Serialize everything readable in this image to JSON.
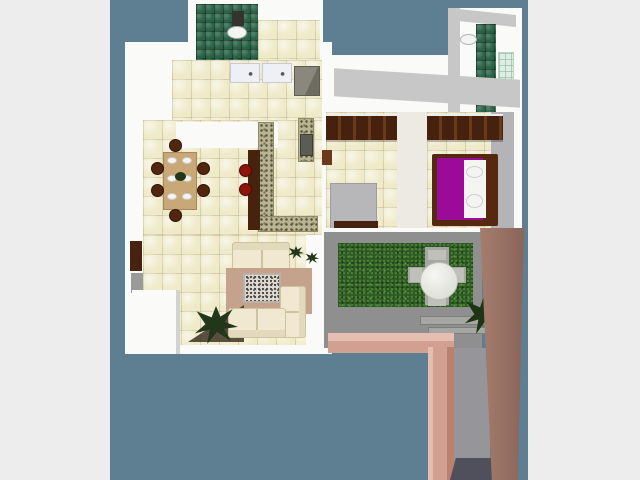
{
  "meta": {
    "content_type": "3d-floorplan-top-view-render",
    "canvas": {
      "width": 640,
      "height": 480
    },
    "photo_area": {
      "x": 110,
      "y": 0,
      "width": 418,
      "height": 480
    }
  },
  "palette": {
    "page_bg": "#ededed",
    "photo_bg": "#5e7e91",
    "wall": "#fafaf8",
    "wall_shade": "#c7c7c7",
    "fixture_white": "#f4f4f0",
    "dark_fixture": "#35332e",
    "stove_dark": "#5c5c56",
    "wood_dark": "#46220f",
    "wood_mid": "#6b3a1d",
    "chair_brown": "#52250f",
    "stool_red": "#8c150c",
    "table_tan": "#c9a877",
    "rug": "#c5a28c",
    "shadow_brown": "#3e3223",
    "bed_gray": "#b7b7ba",
    "bed_frame": "#55280f",
    "bed_purple": "#9c0a9a",
    "hall_white": "#eceae2",
    "closet_gray": "#b4b4b8",
    "concrete": "#8f8f90",
    "paving": "#a6a6a2",
    "patio_chair": "#c0c0bb",
    "pink": "#d2a091",
    "pink_light": "#e4bfb1",
    "corridor_gray": "#95959a",
    "shadow_dark": "#50505c",
    "plant_dark": "#22361a",
    "plant_green": "#1e3514",
    "door_gray": "#9a9a9a",
    "tile_cream": "#efebca",
    "tile_green": "#2a6247",
    "grass_green": "#2f5a26",
    "granite_speckle": "#b9b592",
    "garden_wall_brown": "#9b7767"
  },
  "semantic_regions": [
    "bathroom",
    "laundry",
    "kitchen",
    "dining-room",
    "living-room",
    "bedrooms-hallway",
    "bedroom-1",
    "bedroom-2",
    "bathroom-tower",
    "patio-garden"
  ],
  "scene": {
    "elements": [
      {
        "name": "page-backdrop",
        "rect": [
          0,
          0,
          640,
          480
        ],
        "fill": "page_bg"
      },
      {
        "name": "photo-backdrop",
        "rect": [
          110,
          0,
          418,
          480
        ],
        "fill": "photo_bg"
      },
      {
        "name": "house-slab-main",
        "rect": [
          125,
          42,
          207,
          312
        ],
        "fill": "wall"
      },
      {
        "name": "house-slab-bathroom",
        "rect": [
          188,
          0,
          135,
          62
        ],
        "fill": "wall"
      },
      {
        "name": "house-slab-right-wing",
        "rect": [
          322,
          55,
          200,
          180
        ],
        "fill": "wall"
      },
      {
        "name": "bathroom-tower-slab",
        "rect": [
          448,
          8,
          74,
          128
        ],
        "fill": "wall"
      },
      {
        "name": "tower-left-shade",
        "rect": [
          448,
          8,
          12,
          128
        ],
        "fill": "wall_shade"
      },
      {
        "name": "tower-top-shade",
        "rect": [
          458,
          12,
          58,
          12
        ],
        "fill": "wall_shade",
        "css": "transform:skewY(6deg)"
      },
      {
        "name": "tower-shower-tiles",
        "rect": [
          476,
          24,
          20,
          98
        ],
        "cls": "gtiles"
      },
      {
        "name": "tower-glass-panel",
        "rect": [
          498,
          52,
          16,
          46
        ],
        "cls": "glass"
      },
      {
        "name": "tower-sink",
        "rect": [
          460,
          34,
          17,
          11
        ],
        "fill": "fixture_white",
        "css": "border-radius:50%;border:1px solid #b5b5b5"
      },
      {
        "name": "bathroom-floor-tiles",
        "rect": [
          196,
          4,
          62,
          56
        ],
        "cls": "gtiles"
      },
      {
        "name": "toilet-cistern",
        "rect": [
          232,
          11,
          12,
          15
        ],
        "fill": "dark_fixture"
      },
      {
        "name": "toilet-bowl",
        "rect": [
          227,
          26,
          20,
          13
        ],
        "fill": "fixture_white",
        "css": "border-radius:50%;border:1px solid #a8a8a8"
      },
      {
        "name": "laundry-floor-tiles",
        "rect": [
          258,
          20,
          62,
          42
        ],
        "cls": "tiles"
      },
      {
        "name": "kitchen-floor-tiles",
        "rect": [
          172,
          60,
          150,
          62
        ],
        "cls": "tiles"
      },
      {
        "name": "dining-floor-tiles",
        "rect": [
          143,
          120,
          179,
          115
        ],
        "cls": "tiles"
      },
      {
        "name": "kitchen-dining-wall",
        "rect": [
          176,
          122,
          102,
          26
        ],
        "fill": "wall"
      },
      {
        "name": "kitchen-counter-left",
        "rect": [
          230,
          63,
          30,
          20
        ],
        "cls": "counter"
      },
      {
        "name": "kitchen-counter-right",
        "rect": [
          262,
          63,
          30,
          20
        ],
        "cls": "counter"
      },
      {
        "name": "refrigerator",
        "rect": [
          294,
          66,
          26,
          30
        ],
        "cls": "fridge"
      },
      {
        "name": "granite-counter-upper",
        "rect": [
          298,
          118,
          16,
          44
        ],
        "cls": "granite"
      },
      {
        "name": "stove",
        "rect": [
          300,
          134,
          13,
          22
        ],
        "fill": "stove_dark",
        "css": "border:1px solid #3c3c38"
      },
      {
        "name": "granite-counter-left",
        "rect": [
          258,
          122,
          16,
          108
        ],
        "cls": "granite"
      },
      {
        "name": "granite-counter-bottom",
        "rect": [
          258,
          216,
          60,
          16
        ],
        "cls": "granite"
      },
      {
        "name": "breakfast-bar",
        "rect": [
          248,
          150,
          12,
          80
        ],
        "fill": "wood_dark"
      },
      {
        "name": "bar-stool-1",
        "rect": [
          239,
          164,
          13,
          13
        ],
        "fill": "stool_red",
        "css": "border-radius:50%;border:1px solid #490a05"
      },
      {
        "name": "bar-stool-2",
        "rect": [
          239,
          183,
          13,
          13
        ],
        "fill": "stool_red",
        "css": "border-radius:50%;border:1px solid #490a05"
      },
      {
        "name": "dining-table",
        "rect": [
          163,
          152,
          34,
          58
        ],
        "fill": "table_tan",
        "css": "border:1px solid #a9855b"
      },
      {
        "name": "dinner-plate-1",
        "rect": [
          167,
          157,
          10,
          7
        ],
        "fill": "fixture_white",
        "css": "border-radius:50%;border:1px solid #c9c9c9"
      },
      {
        "name": "dinner-plate-2",
        "rect": [
          182,
          157,
          10,
          7
        ],
        "fill": "fixture_white",
        "css": "border-radius:50%;border:1px solid #c9c9c9"
      },
      {
        "name": "dinner-plate-3",
        "rect": [
          167,
          175,
          10,
          7
        ],
        "fill": "fixture_white",
        "css": "border-radius:50%;border:1px solid #c9c9c9"
      },
      {
        "name": "dinner-plate-4",
        "rect": [
          182,
          175,
          10,
          7
        ],
        "fill": "fixture_white",
        "css": "border-radius:50%;border:1px solid #c9c9c9"
      },
      {
        "name": "dinner-plate-5",
        "rect": [
          167,
          193,
          10,
          7
        ],
        "fill": "fixture_white",
        "css": "border-radius:50%;border:1px solid #c9c9c9"
      },
      {
        "name": "dinner-plate-6",
        "rect": [
          182,
          193,
          10,
          7
        ],
        "fill": "fixture_white",
        "css": "border-radius:50%;border:1px solid #c9c9c9"
      },
      {
        "name": "table-centerpiece",
        "rect": [
          175,
          172,
          11,
          9
        ],
        "fill": "plant_dark",
        "css": "border-radius:50%"
      },
      {
        "name": "dining-chair-top",
        "rect": [
          169,
          139,
          13,
          13
        ],
        "fill": "chair_brown",
        "css": "border-radius:50%;border:1px solid #2e1206"
      },
      {
        "name": "dining-chair-bottom",
        "rect": [
          169,
          209,
          13,
          13
        ],
        "fill": "chair_brown",
        "css": "border-radius:50%;border:1px solid #2e1206"
      },
      {
        "name": "dining-chair-left-1",
        "rect": [
          151,
          162,
          13,
          13
        ],
        "fill": "chair_brown",
        "css": "border-radius:50%;border:1px solid #2e1206"
      },
      {
        "name": "dining-chair-left-2",
        "rect": [
          151,
          184,
          13,
          13
        ],
        "fill": "chair_brown",
        "css": "border-radius:50%;border:1px solid #2e1206"
      },
      {
        "name": "dining-chair-right-1",
        "rect": [
          197,
          162,
          13,
          13
        ],
        "fill": "chair_brown",
        "css": "border-radius:50%;border:1px solid #2e1206"
      },
      {
        "name": "dining-chair-right-2",
        "rect": [
          197,
          184,
          13,
          13
        ],
        "fill": "chair_brown",
        "css": "border-radius:50%;border:1px solid #2e1206"
      },
      {
        "name": "living-floor-tiles",
        "rect": [
          143,
          235,
          163,
          110
        ],
        "cls": "tiles"
      },
      {
        "name": "living-patio-wall",
        "rect": [
          310,
          235,
          15,
          119
        ],
        "fill": "wall"
      },
      {
        "name": "entry-door-brown",
        "rect": [
          130,
          241,
          12,
          30
        ],
        "fill": "wood_dark"
      },
      {
        "name": "entry-door-gray",
        "rect": [
          131,
          273,
          12,
          20
        ],
        "fill": "door_gray"
      },
      {
        "name": "terrace-wall-block",
        "rect": [
          132,
          290,
          48,
          64
        ],
        "fill": "wall",
        "css": "box-shadow:inset -4px 0 0 #d2d2d2"
      },
      {
        "name": "loveseat-sofa",
        "rect": [
          232,
          242,
          58,
          28
        ],
        "cls": "sofa",
        "css": "box-shadow:inset 0 7px 0 #e3dabd;background-image:linear-gradient(90deg,transparent 0 28px,#cdc3a0 28px 30px,transparent 30px)"
      },
      {
        "name": "area-rug",
        "rect": [
          226,
          268,
          86,
          46
        ],
        "fill": "rug"
      },
      {
        "name": "patterned-carpet",
        "rect": [
          243,
          273,
          38,
          30
        ],
        "cls": "carpet"
      },
      {
        "name": "plant-shadow",
        "rect": [
          188,
          300,
          56,
          42
        ],
        "fill": "shadow_brown",
        "css": "clip-path:polygon(0 100%,100% 12%,100% 100%);opacity:.85"
      },
      {
        "name": "sectional-sofa-right",
        "rect": [
          280,
          286,
          26,
          52
        ],
        "cls": "sofa",
        "css": "box-shadow:inset -6px 0 0 #e3dabd;background-image:linear-gradient(transparent 0 24px,#cdc3a0 24px 26px,transparent 26px)"
      },
      {
        "name": "sectional-sofa-bottom",
        "rect": [
          228,
          308,
          58,
          30
        ],
        "cls": "sofa",
        "css": "box-shadow:inset 0 -7px 0 #e3dabd;background-image:linear-gradient(90deg,transparent 0 27px,#cdc3a0 27px 29px,transparent 29px)"
      },
      {
        "name": "living-floor-plant",
        "rect": [
          194,
          306,
          44,
          38
        ],
        "cls": "plant",
        "fill": "plant_dark"
      },
      {
        "name": "decor-plant-1",
        "rect": [
          288,
          246,
          16,
          13
        ],
        "cls": "plant",
        "fill": "plant_dark"
      },
      {
        "name": "decor-plant-2",
        "rect": [
          305,
          252,
          14,
          12
        ],
        "cls": "plant",
        "fill": "plant_dark"
      },
      {
        "name": "wing-roof-shade",
        "rect": [
          334,
          74,
          186,
          28
        ],
        "fill": "wall_shade",
        "css": "transform:skewY(3.5deg)"
      },
      {
        "name": "bedroom1-floor-tiles",
        "rect": [
          326,
          112,
          71,
          118
        ],
        "cls": "tiles"
      },
      {
        "name": "bedroom1-wardrobe",
        "rect": [
          326,
          114,
          71,
          26
        ],
        "cls": "wardrobe"
      },
      {
        "name": "bedroom1-nightstand",
        "rect": [
          322,
          150,
          10,
          15
        ],
        "fill": "wood_mid"
      },
      {
        "name": "bedroom1-bed",
        "rect": [
          330,
          183,
          47,
          46
        ],
        "fill": "bed_gray",
        "css": "border:1px solid #9d9da0"
      },
      {
        "name": "bedroom1-bed-footboard",
        "rect": [
          334,
          221,
          44,
          9
        ],
        "fill": "wood_dark"
      },
      {
        "name": "bedrooms-hallway-floor",
        "rect": [
          397,
          112,
          30,
          118
        ],
        "fill": "hall_white"
      },
      {
        "name": "bedroom2-closet",
        "rect": [
          490,
          112,
          24,
          118
        ],
        "fill": "closet_gray"
      },
      {
        "name": "bedroom2-floor-tiles",
        "rect": [
          427,
          112,
          64,
          118
        ],
        "cls": "tiles"
      },
      {
        "name": "bedroom2-wardrobe",
        "rect": [
          427,
          114,
          76,
          26
        ],
        "cls": "wardrobe"
      },
      {
        "name": "bedroom2-bed-frame",
        "rect": [
          432,
          154,
          66,
          72
        ],
        "fill": "bed_frame",
        "css": "border-radius:2px"
      },
      {
        "name": "bedroom2-bed-purple-cover",
        "rect": [
          437,
          158,
          46,
          62
        ],
        "fill": "bed_purple"
      },
      {
        "name": "bedroom2-mattress",
        "rect": [
          464,
          160,
          22,
          58
        ],
        "fill": "fixture_white"
      },
      {
        "name": "bedroom2-pillow-1",
        "rect": [
          466,
          166,
          17,
          12
        ],
        "fill": "fixture_white",
        "css": "border:1px solid #cfcfcf;border-radius:50%"
      },
      {
        "name": "bedroom2-pillow-2",
        "rect": [
          466,
          194,
          17,
          14
        ],
        "fill": "fixture_white",
        "css": "border:1px solid #cfcfcf;border-radius:50%"
      },
      {
        "name": "wing-bottom-wall",
        "rect": [
          322,
          228,
          200,
          12
        ],
        "fill": "wall"
      },
      {
        "name": "patio-floor",
        "rect": [
          324,
          232,
          158,
          116
        ],
        "fill": "concrete"
      },
      {
        "name": "lawn",
        "rect": [
          338,
          243,
          135,
          64
        ],
        "cls": "grass"
      },
      {
        "name": "paving-cross-vertical",
        "rect": [
          425,
          247,
          24,
          58
        ],
        "fill": "paving"
      },
      {
        "name": "paving-cross-horizontal",
        "rect": [
          408,
          267,
          58,
          16
        ],
        "fill": "paving"
      },
      {
        "name": "patio-chair-north",
        "rect": [
          428,
          250,
          18,
          10
        ],
        "fill": "patio_chair"
      },
      {
        "name": "patio-chair-south",
        "rect": [
          428,
          296,
          18,
          10
        ],
        "fill": "patio_chair"
      },
      {
        "name": "patio-chair-west",
        "rect": [
          410,
          268,
          12,
          14
        ],
        "fill": "patio_chair"
      },
      {
        "name": "patio-chair-east",
        "rect": [
          452,
          268,
          12,
          14
        ],
        "fill": "patio_chair"
      },
      {
        "name": "patio-round-table",
        "rect": [
          420,
          262,
          38,
          38
        ],
        "cls": "ptable"
      },
      {
        "name": "garden-bench-1",
        "rect": [
          420,
          316,
          70,
          9
        ],
        "fill": "paving",
        "css": "border:1px solid #7e7e7c"
      },
      {
        "name": "garden-bench-2",
        "rect": [
          428,
          327,
          58,
          7
        ],
        "fill": "paving",
        "css": "border:1px solid #7e7e7c"
      },
      {
        "name": "patio-plant",
        "rect": [
          464,
          296,
          40,
          38
        ],
        "cls": "plant",
        "fill": "plant_green"
      },
      {
        "name": "pink-wall-top-face",
        "rect": [
          328,
          333,
          126,
          8
        ],
        "fill": "pink_light"
      },
      {
        "name": "pink-wall-horizontal",
        "rect": [
          328,
          341,
          126,
          12
        ],
        "fill": "pink"
      },
      {
        "name": "pink-wall-vertical",
        "rect": [
          428,
          347,
          26,
          133
        ],
        "css": "background:linear-gradient(90deg,#e4bfb1 0 5px,#d2a091 5px 19px,#b9826f 19px)"
      },
      {
        "name": "patio-corridor-floor",
        "rect": [
          454,
          348,
          36,
          122
        ],
        "fill": "corridor_gray"
      },
      {
        "name": "corridor-shadow",
        "rect": [
          450,
          458,
          58,
          22
        ],
        "fill": "shadow_dark",
        "css": "clip-path:polygon(10% 0,100% 0,90% 100%,0 100%)"
      },
      {
        "name": "garden-brown-wall",
        "rect": [
          480,
          228,
          44,
          252
        ],
        "css": "background:linear-gradient(90deg,#a57d6d,#8a655a);clip-path:polygon(0 0,100% 0,86% 100%,27% 100%)"
      }
    ]
  }
}
